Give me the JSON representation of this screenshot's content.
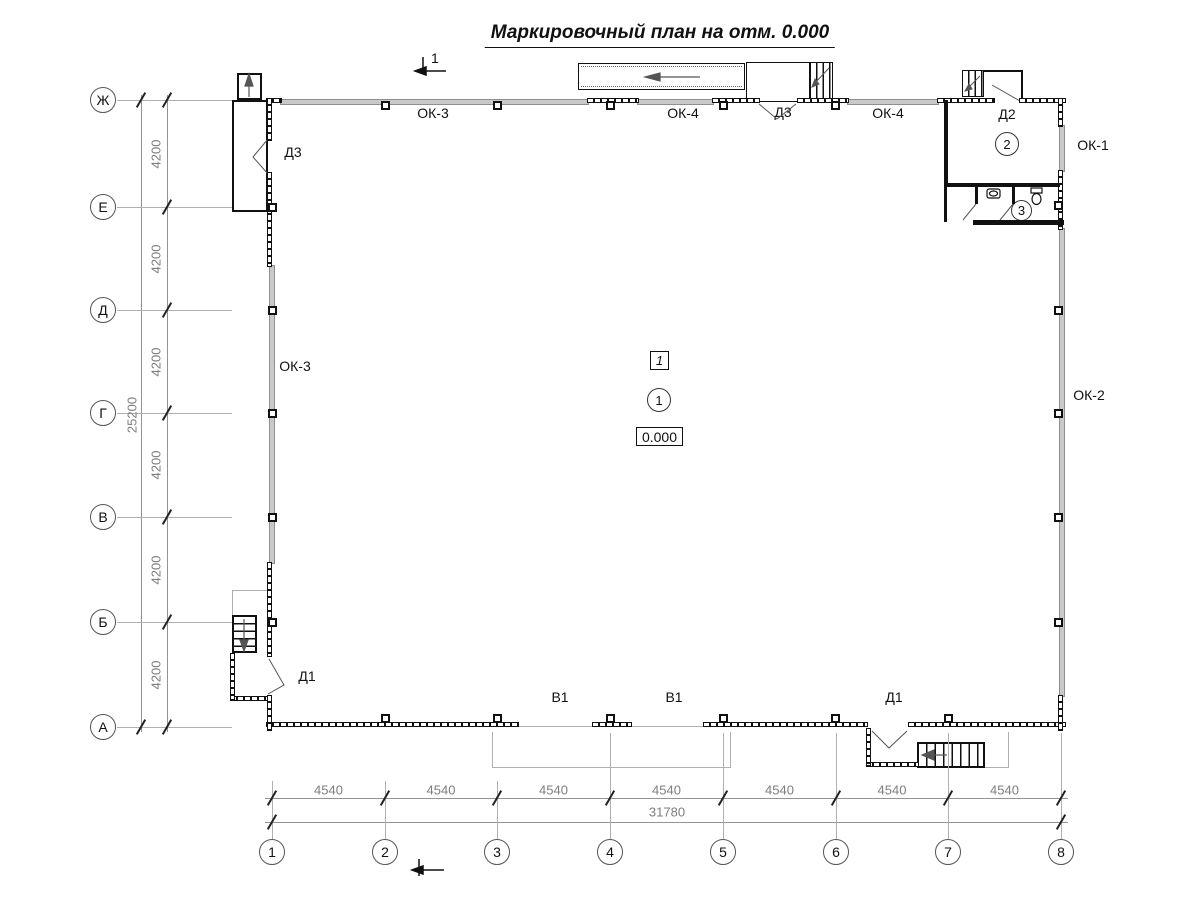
{
  "title": "Маркировочный план на отм. 0.000",
  "section_mark": {
    "number": "1"
  },
  "grid": {
    "bottom_axes": [
      "1",
      "2",
      "3",
      "4",
      "5",
      "6",
      "7",
      "8"
    ],
    "left_axes": [
      "Ж",
      "Е",
      "Д",
      "Г",
      "В",
      "Б",
      "А"
    ]
  },
  "dimensions": {
    "bottom_segments": [
      "4540",
      "4540",
      "4540",
      "4540",
      "4540",
      "4540",
      "4540"
    ],
    "bottom_total": "31780",
    "left_segments": [
      "4200",
      "4200",
      "4200",
      "4200",
      "4200",
      "4200"
    ],
    "left_total": "25200"
  },
  "marks": {
    "ok3_top": "ОК-3",
    "ok4_left": "ОК-4",
    "d3_top": "Д3",
    "ok4_right": "ОК-4",
    "d2": "Д2",
    "ok1": "ОК-1",
    "ok3_left": "ОК-3",
    "ok2": "ОК-2",
    "d3_west": "Д3",
    "d1_west": "Д1",
    "v1_left": "В1",
    "v1_right": "В1",
    "d1_south": "Д1"
  },
  "rooms": {
    "hall_number": "1",
    "hall_zone_mark": "1",
    "elevation": "0.000",
    "vestibule_number": "2",
    "wc_number": "3"
  },
  "colors": {
    "line": "#111111",
    "wall_gray": "#c9c9c9",
    "grid_line": "#b0b0b0",
    "dim_text": "#7d7d7d"
  }
}
